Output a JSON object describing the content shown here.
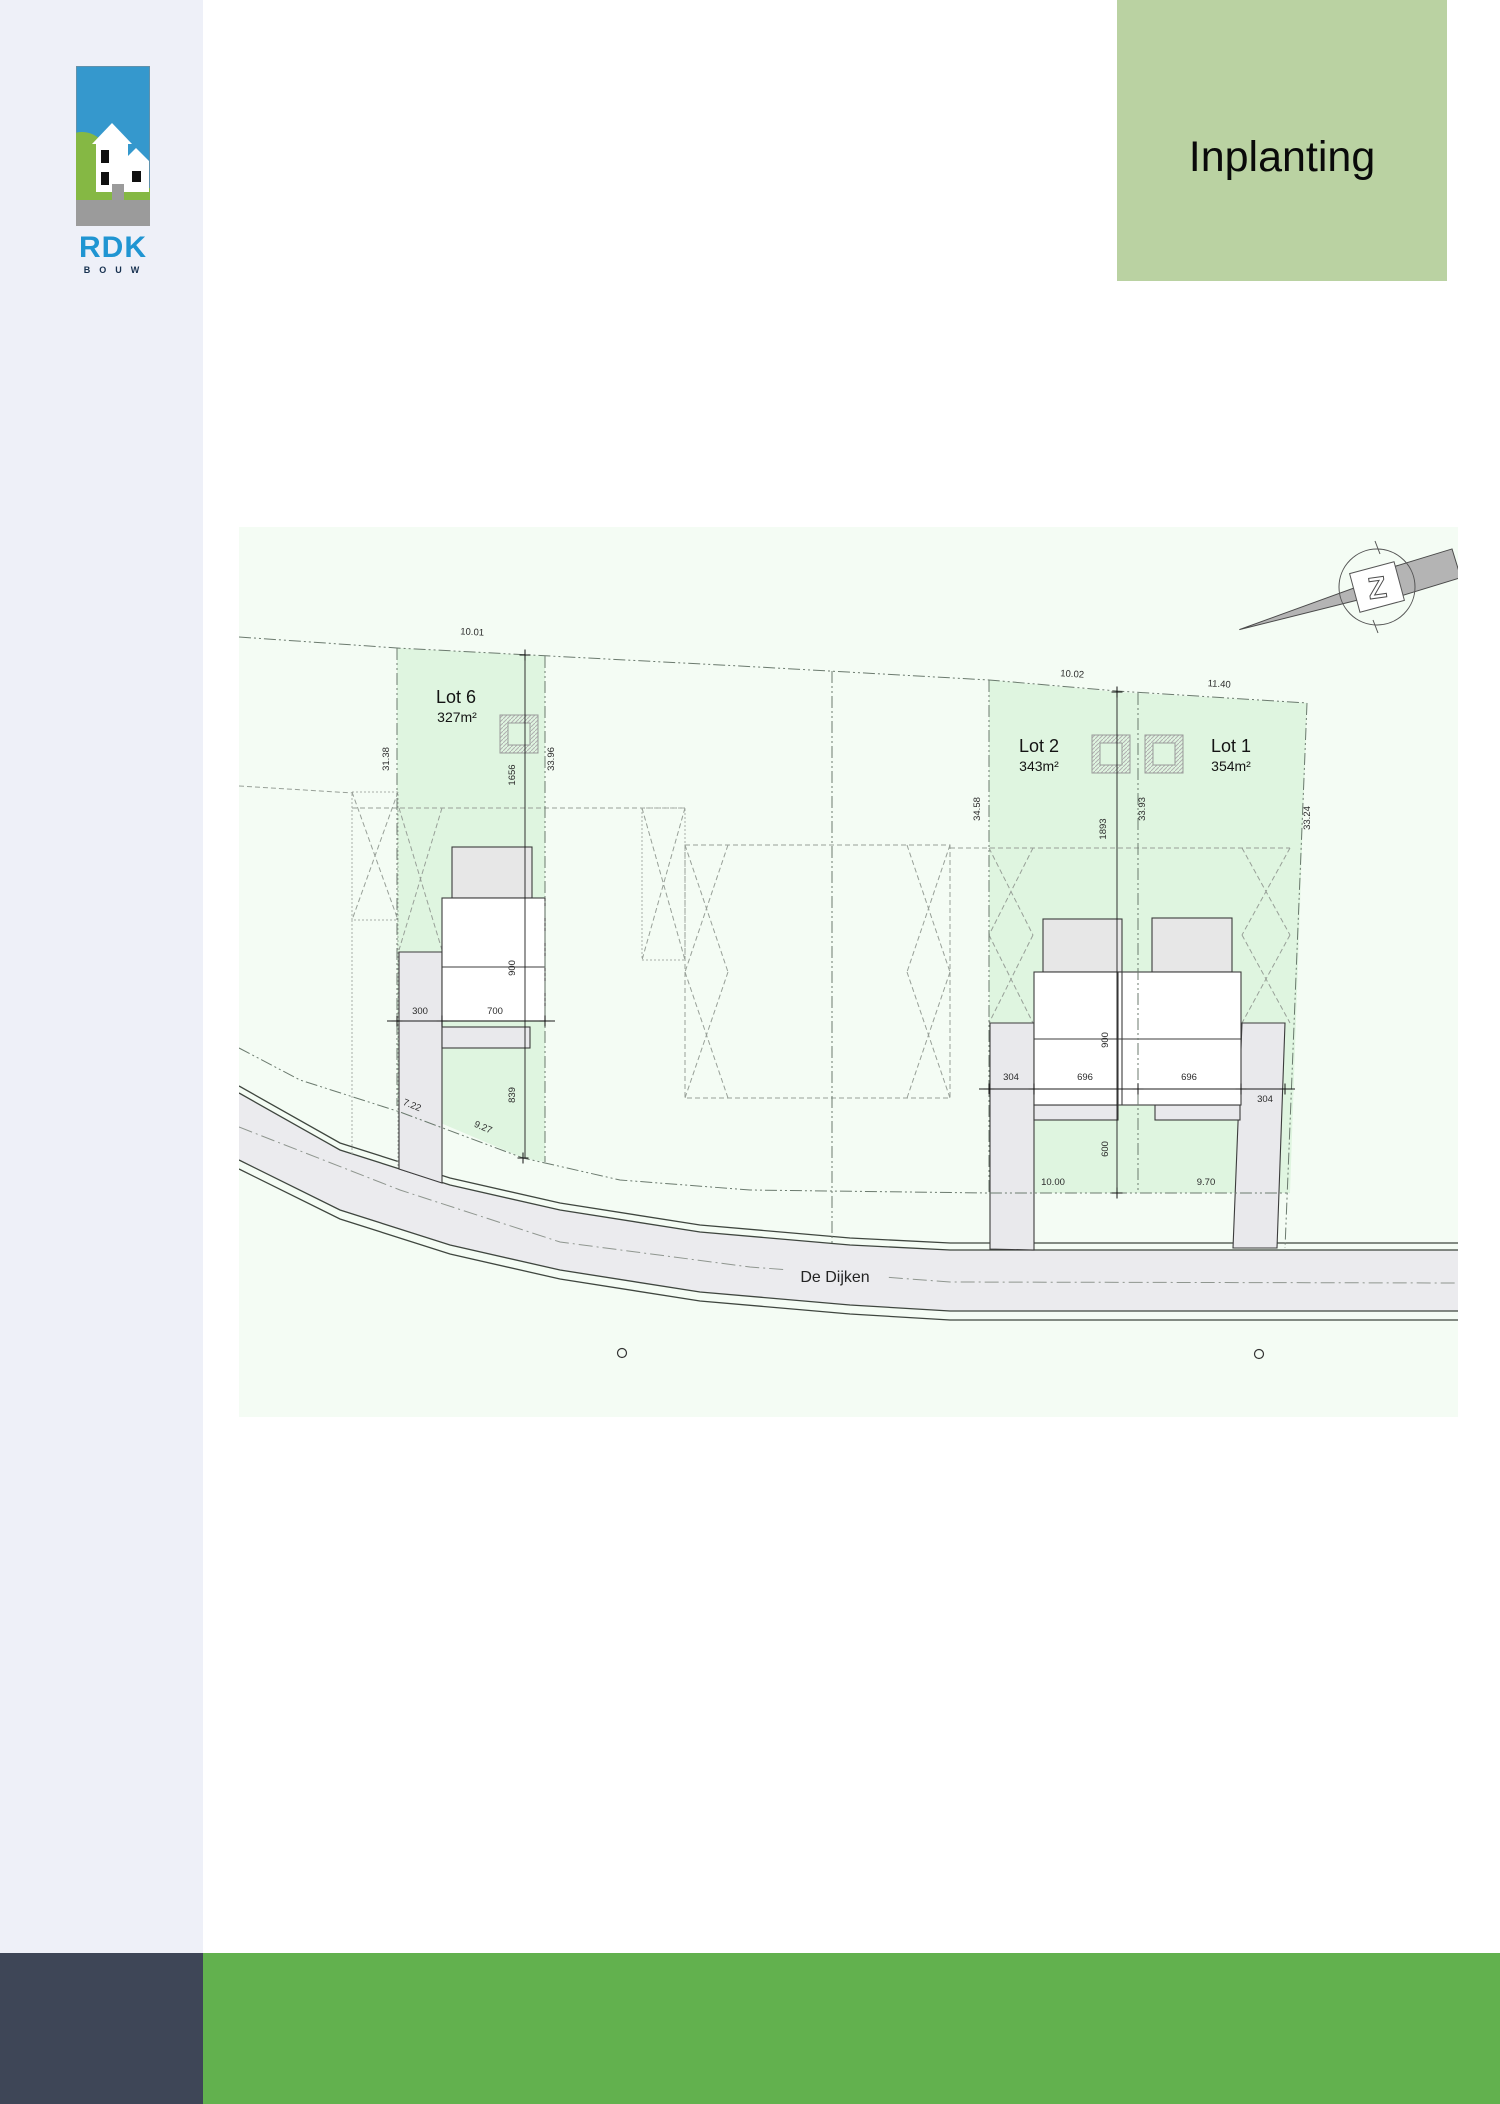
{
  "header": {
    "title": "Inplanting"
  },
  "logo": {
    "brand": "RDK",
    "sub": "BOUW"
  },
  "plan": {
    "street": "De Dijken",
    "north_letter": "Z",
    "lots": [
      {
        "name": "Lot 6",
        "area": "327m²"
      },
      {
        "name": "Lot 2",
        "area": "343m²"
      },
      {
        "name": "Lot 1",
        "area": "354m²"
      }
    ],
    "dims": {
      "lot6_top": "10.01",
      "lot6_left": "31.38",
      "lot6_right": "33.96",
      "lot6_depth": "1656",
      "lot6_house_depth": "900",
      "lot6_front_strip": "300",
      "lot6_front_width": "700",
      "lot6_rear": "839",
      "lot6_slope_a": "7.22",
      "lot6_slope_b": "9.27",
      "lot2_top": "10.02",
      "lot1_top": "11.40",
      "lot2_left": "34.58",
      "divider": "33.93",
      "lot1_right": "33.24",
      "center_depth": "1893",
      "house_depth": "900",
      "front_left": "304",
      "front_w1": "696",
      "front_w2": "696",
      "front_right": "304",
      "garden_depth": "600",
      "lot2_front": "10.00",
      "lot1_front": "9.70"
    }
  },
  "colors": {
    "header_green": "#bad2a2",
    "footer_green": "#62b14e",
    "footer_dark": "#3e4657",
    "lot_fill": "#dff5e0",
    "plan_bg": "#f4fcf4",
    "brand_blue": "#2095d2"
  }
}
